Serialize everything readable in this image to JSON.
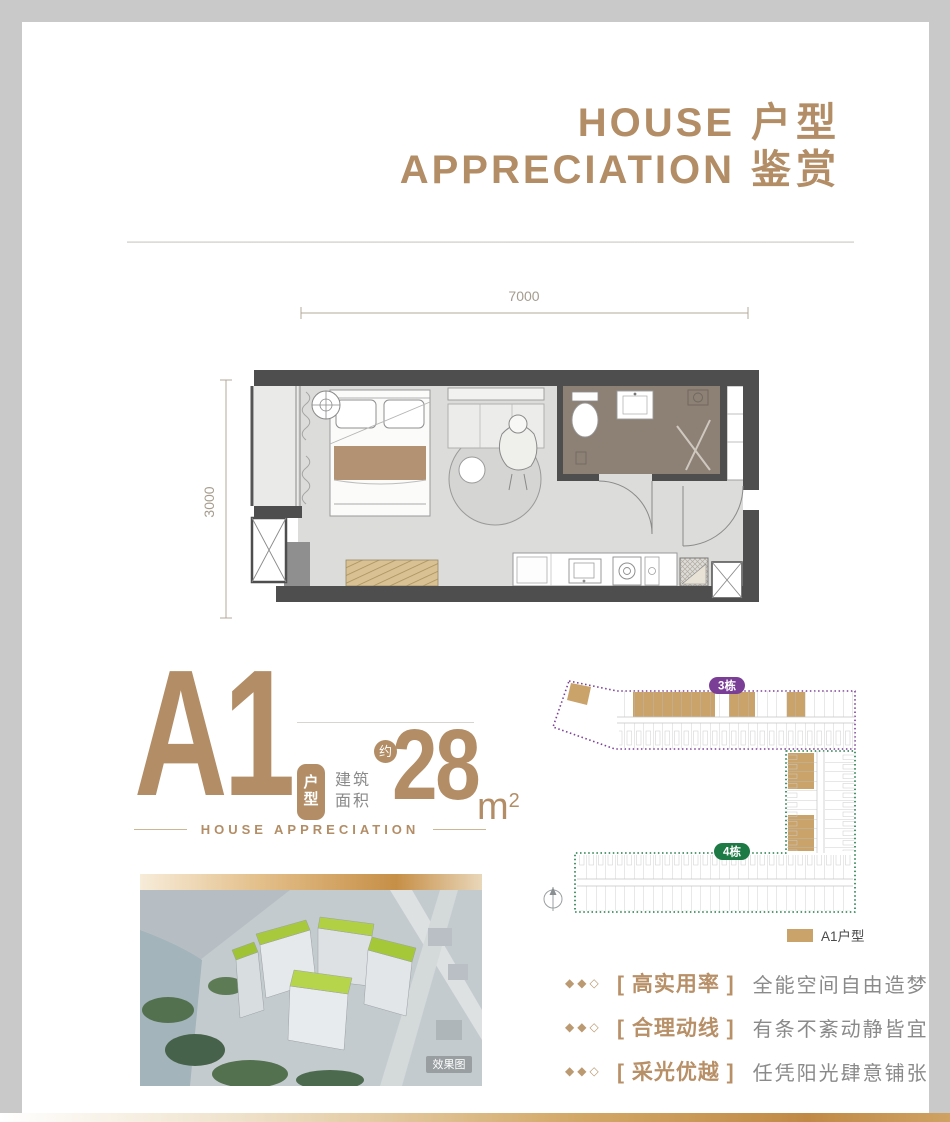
{
  "header": {
    "title_en_1": "HOUSE",
    "title_cn_1": "户型",
    "title_en_2": "APPRECIATION",
    "title_cn_2": "鉴赏"
  },
  "floorplan": {
    "dim_width": "7000",
    "dim_height": "3000"
  },
  "unit_info": {
    "name": "A1",
    "type_badge": "户型",
    "approx_badge": "约",
    "area_label_1": "建筑",
    "area_label_2": "面积",
    "area_value": "28",
    "area_unit": "m",
    "area_unit_sup": "2",
    "tagline": "HOUSE APPRECIATION"
  },
  "render": {
    "watermark": "效果图"
  },
  "siteplan": {
    "building_3": "3栋",
    "building_4": "4栋",
    "legend": "A1户型"
  },
  "features": [
    {
      "bullets": "◆◆◇",
      "tag": "[ 高实用率 ]",
      "desc": "全能空间自由造梦"
    },
    {
      "bullets": "◆◆◇",
      "tag": "[ 合理动线 ]",
      "desc": "有条不紊动静皆宜"
    },
    {
      "bullets": "◆◆◇",
      "tag": "[ 采光优越 ]",
      "desc": "任凭阳光肆意铺张"
    }
  ],
  "colors": {
    "gold": "#b28d66",
    "unit_gold": "#c9a36a",
    "purple": "#7b3e97",
    "green": "#1e7a45",
    "wall": "#4e4e4e",
    "bathroom_floor": "#8d8075",
    "floor": "#dcdcda"
  }
}
